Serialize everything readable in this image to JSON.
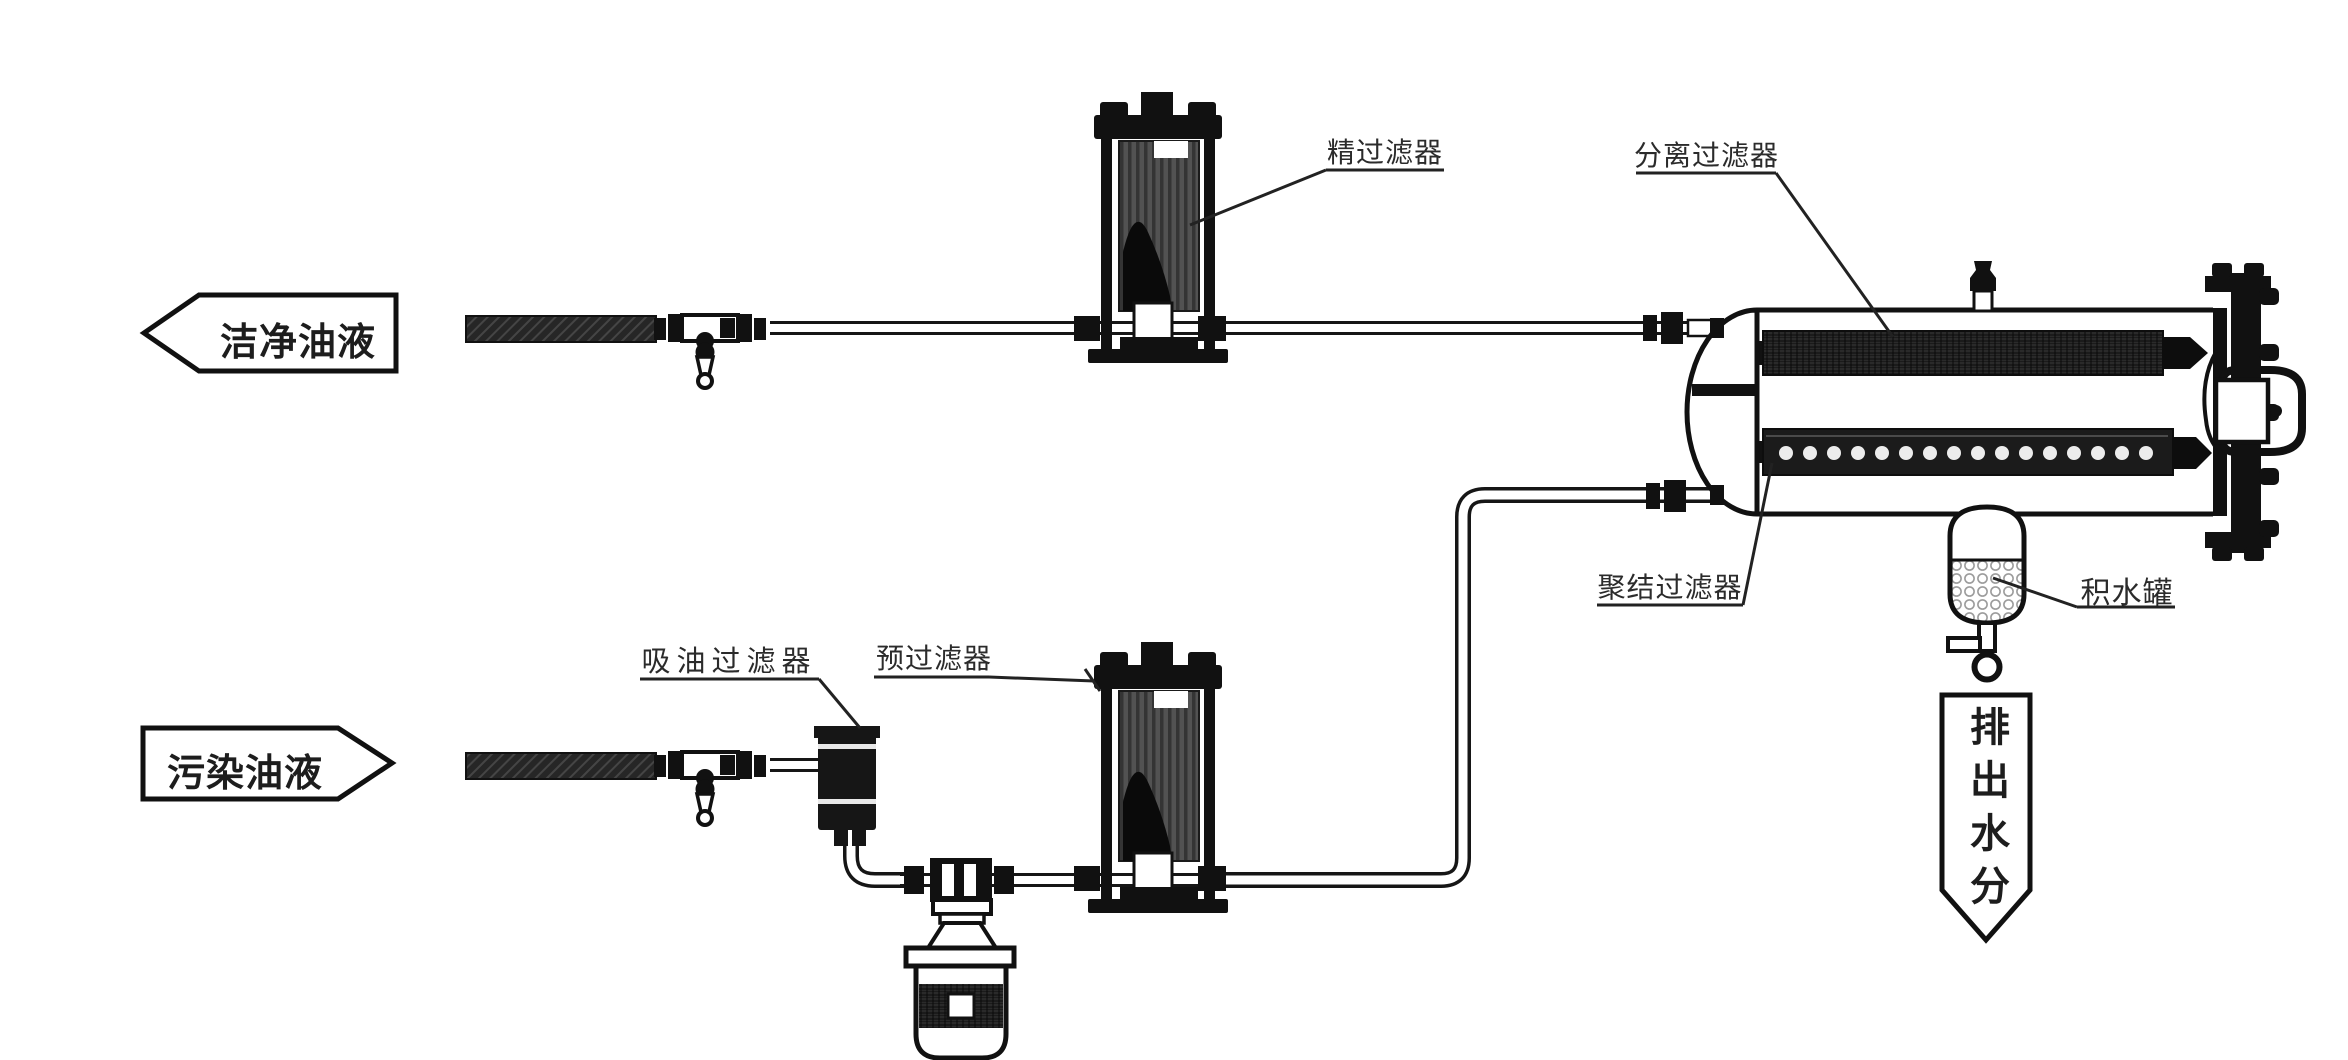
{
  "diagram": {
    "flow_arrows": {
      "clean_oil": "洁净油液",
      "contaminated_oil": "污染油液",
      "discharge_water": "排出水分"
    },
    "labels": {
      "fine_filter": "精过滤器",
      "separation_filter": "分离过滤器",
      "coalescing_filter": "聚结过滤器",
      "water_tank": "积水罐",
      "suction_filter": "吸油过滤器",
      "pre_filter": "预过滤器"
    },
    "colors": {
      "line": "#161616",
      "background": "#ffffff",
      "element_dark": "#1b1b1b",
      "filter_body": "#4f4f4f",
      "water_mesh": "#9c9c9c"
    }
  }
}
